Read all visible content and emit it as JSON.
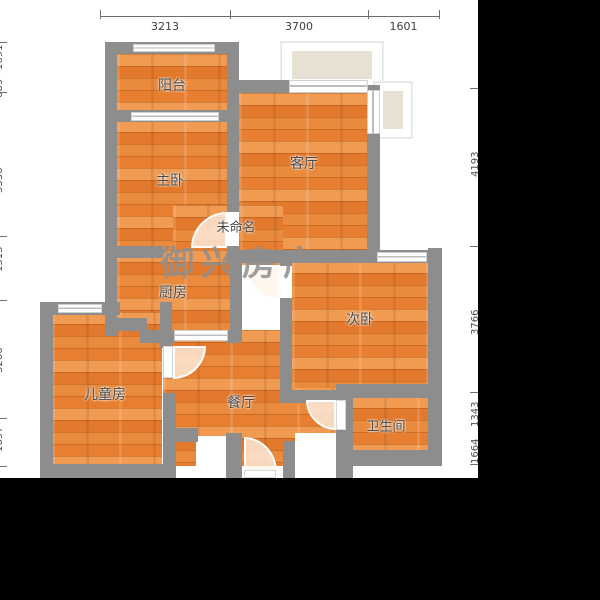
{
  "watermark": "御兴房产",
  "rooms": {
    "balcony": "阳台",
    "master_bedroom": "主卧",
    "living_room": "客厅",
    "unnamed": "未命名",
    "kitchen": "厨房",
    "second_bedroom": "次卧",
    "children_room": "儿童房",
    "dining_room": "餐厅",
    "bathroom": "卫生间"
  },
  "dimensions": {
    "top": [
      "3213",
      "3700",
      "1601"
    ],
    "left": [
      "1691",
      "689",
      "3356",
      "1313",
      "3266",
      "1697"
    ],
    "right": [
      "4193",
      "3766",
      "1343",
      "1664"
    ]
  },
  "colors": {
    "wall": "#8d8d8d",
    "floor": "#e98a3f",
    "floor_dark": "#e2792c",
    "floor_light": "#f09a52",
    "bay_window_fill": "#e7e1d3",
    "background": "#000000",
    "plan_background": "#ffffff",
    "label_text": "#4a4a4a",
    "watermark_text": "#8f8f8f"
  }
}
